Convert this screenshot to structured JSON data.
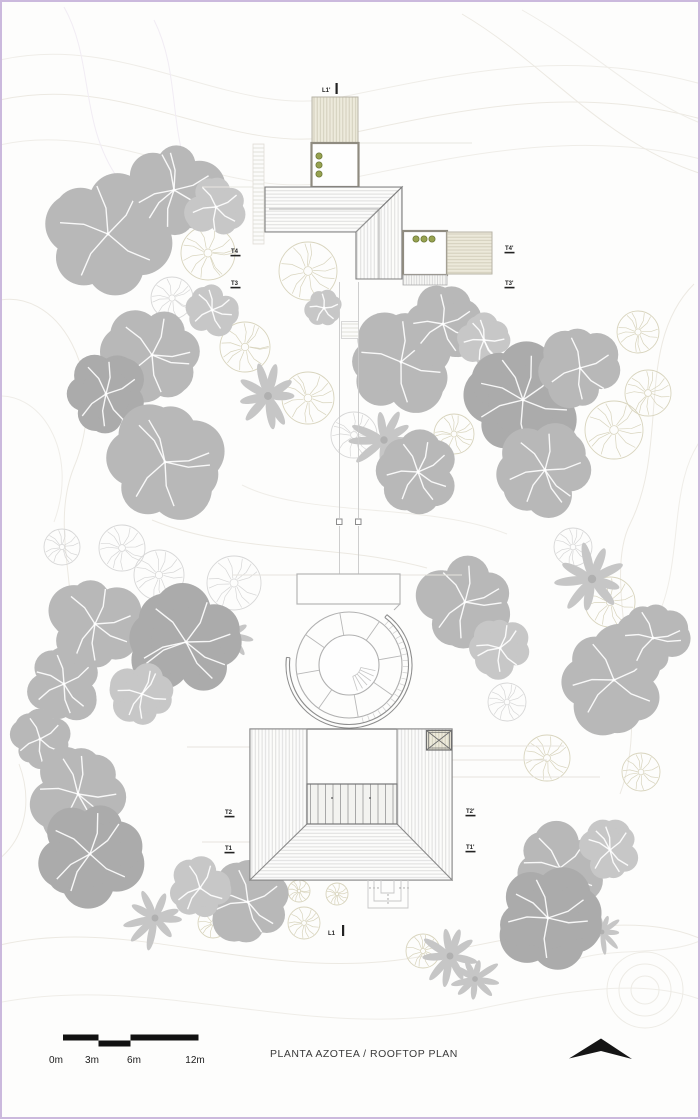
{
  "labels": {
    "title": "PLANTA AZOTEA / ROOFTOP PLAN"
  },
  "scale_bar": {
    "labels": [
      "0m",
      "3m",
      "6m",
      "12m"
    ]
  },
  "section_markers": [
    {
      "label": "T4",
      "x": 229,
      "y": 251
    },
    {
      "label": "T3",
      "x": 229,
      "y": 283
    },
    {
      "label": "T4'",
      "x": 503,
      "y": 248
    },
    {
      "label": "T3'",
      "x": 503,
      "y": 283
    },
    {
      "label": "T2",
      "x": 223,
      "y": 812
    },
    {
      "label": "T1",
      "x": 223,
      "y": 848
    },
    {
      "label": "T2'",
      "x": 464,
      "y": 811
    },
    {
      "label": "T1'",
      "x": 464,
      "y": 847
    }
  ],
  "cut_markers": [
    {
      "label": "L1'",
      "x": 320,
      "y": 90,
      "bar": [
        333.5,
        81,
        92
      ]
    },
    {
      "label": "L1",
      "x": 326,
      "y": 933,
      "bar": [
        340,
        923,
        934
      ]
    }
  ],
  "colors": {
    "canopy": {
      "dark": "#ababab",
      "mid": "#b8b8b8",
      "light": "#c7c7c7"
    },
    "palm": "#c6c6c6",
    "outline_gray": "#d7d7d7",
    "outline_olive": "#d8d4bd",
    "planter_fill": "#97a250",
    "planter_stroke": "#6e7a38",
    "marker_text": "#222222",
    "frame_border": "#cbb9dd",
    "north_arrow": "#151515"
  },
  "trees": {
    "canopy": [
      {
        "x": 106,
        "y": 232,
        "r": 58,
        "s": "mid"
      },
      {
        "x": 172,
        "y": 188,
        "r": 44,
        "s": "mid"
      },
      {
        "x": 214,
        "y": 205,
        "r": 28,
        "s": "light"
      },
      {
        "x": 150,
        "y": 353,
        "r": 45,
        "s": "mid"
      },
      {
        "x": 104,
        "y": 392,
        "r": 38,
        "s": "dark"
      },
      {
        "x": 163,
        "y": 460,
        "r": 53,
        "s": "mid"
      },
      {
        "x": 210,
        "y": 308,
        "r": 24,
        "s": "light"
      },
      {
        "x": 322,
        "y": 306,
        "r": 17,
        "s": "light"
      },
      {
        "x": 399,
        "y": 360,
        "r": 48,
        "s": "mid"
      },
      {
        "x": 441,
        "y": 322,
        "r": 35,
        "s": "mid"
      },
      {
        "x": 482,
        "y": 338,
        "r": 24,
        "s": "light"
      },
      {
        "x": 521,
        "y": 398,
        "r": 53,
        "s": "dark"
      },
      {
        "x": 578,
        "y": 366,
        "r": 37,
        "s": "mid"
      },
      {
        "x": 416,
        "y": 470,
        "r": 37,
        "s": "mid"
      },
      {
        "x": 543,
        "y": 468,
        "r": 43,
        "s": "mid"
      },
      {
        "x": 93,
        "y": 622,
        "r": 43,
        "s": "mid"
      },
      {
        "x": 184,
        "y": 640,
        "r": 53,
        "s": "dark"
      },
      {
        "x": 62,
        "y": 682,
        "r": 35,
        "s": "mid"
      },
      {
        "x": 140,
        "y": 692,
        "r": 29,
        "s": "light"
      },
      {
        "x": 38,
        "y": 737,
        "r": 27,
        "s": "mid"
      },
      {
        "x": 76,
        "y": 792,
        "r": 45,
        "s": "mid"
      },
      {
        "x": 88,
        "y": 852,
        "r": 49,
        "s": "dark"
      },
      {
        "x": 463,
        "y": 600,
        "r": 43,
        "s": "mid"
      },
      {
        "x": 498,
        "y": 646,
        "r": 28,
        "s": "light"
      },
      {
        "x": 612,
        "y": 678,
        "r": 49,
        "s": "mid"
      },
      {
        "x": 651,
        "y": 636,
        "r": 33,
        "s": "mid"
      },
      {
        "x": 246,
        "y": 900,
        "r": 39,
        "s": "mid"
      },
      {
        "x": 198,
        "y": 886,
        "r": 29,
        "s": "light"
      },
      {
        "x": 558,
        "y": 866,
        "r": 43,
        "s": "mid"
      },
      {
        "x": 546,
        "y": 916,
        "r": 47,
        "s": "dark"
      },
      {
        "x": 608,
        "y": 848,
        "r": 28,
        "s": "light"
      }
    ],
    "palm": [
      {
        "x": 266,
        "y": 394,
        "r": 33
      },
      {
        "x": 382,
        "y": 438,
        "r": 31
      },
      {
        "x": 590,
        "y": 577,
        "r": 35
      },
      {
        "x": 228,
        "y": 633,
        "r": 24
      },
      {
        "x": 153,
        "y": 916,
        "r": 29
      },
      {
        "x": 448,
        "y": 954,
        "r": 29
      },
      {
        "x": 473,
        "y": 977,
        "r": 24
      },
      {
        "x": 600,
        "y": 930,
        "r": 20
      }
    ],
    "outline": [
      {
        "x": 206,
        "y": 251,
        "r": 27,
        "t": "o"
      },
      {
        "x": 170,
        "y": 296,
        "r": 21,
        "t": "g"
      },
      {
        "x": 243,
        "y": 345,
        "r": 25,
        "t": "o"
      },
      {
        "x": 306,
        "y": 269,
        "r": 29,
        "t": "o"
      },
      {
        "x": 306,
        "y": 396,
        "r": 26,
        "t": "o"
      },
      {
        "x": 352,
        "y": 433,
        "r": 23,
        "t": "g"
      },
      {
        "x": 452,
        "y": 432,
        "r": 20,
        "t": "o"
      },
      {
        "x": 612,
        "y": 428,
        "r": 29,
        "t": "o"
      },
      {
        "x": 646,
        "y": 391,
        "r": 23,
        "t": "o"
      },
      {
        "x": 636,
        "y": 330,
        "r": 21,
        "t": "o"
      },
      {
        "x": 60,
        "y": 545,
        "r": 18,
        "t": "g"
      },
      {
        "x": 120,
        "y": 546,
        "r": 23,
        "t": "g"
      },
      {
        "x": 157,
        "y": 573,
        "r": 25,
        "t": "g"
      },
      {
        "x": 232,
        "y": 581,
        "r": 27,
        "t": "g"
      },
      {
        "x": 571,
        "y": 545,
        "r": 19,
        "t": "g"
      },
      {
        "x": 608,
        "y": 600,
        "r": 25,
        "t": "o"
      },
      {
        "x": 545,
        "y": 756,
        "r": 23,
        "t": "o"
      },
      {
        "x": 505,
        "y": 700,
        "r": 19,
        "t": "g"
      },
      {
        "x": 639,
        "y": 770,
        "r": 19,
        "t": "o"
      },
      {
        "x": 297,
        "y": 889,
        "r": 11,
        "t": "o"
      },
      {
        "x": 335,
        "y": 892,
        "r": 11,
        "t": "o"
      },
      {
        "x": 302,
        "y": 921,
        "r": 16,
        "t": "o"
      },
      {
        "x": 211,
        "y": 921,
        "r": 15,
        "t": "o"
      },
      {
        "x": 421,
        "y": 949,
        "r": 17,
        "t": "o"
      }
    ]
  },
  "planters": {
    "courtyard_north": [
      [
        317,
        154
      ],
      [
        317,
        163
      ],
      [
        317,
        172
      ]
    ],
    "courtyard_east": [
      [
        414,
        237
      ],
      [
        422,
        237
      ],
      [
        430,
        237
      ]
    ]
  }
}
